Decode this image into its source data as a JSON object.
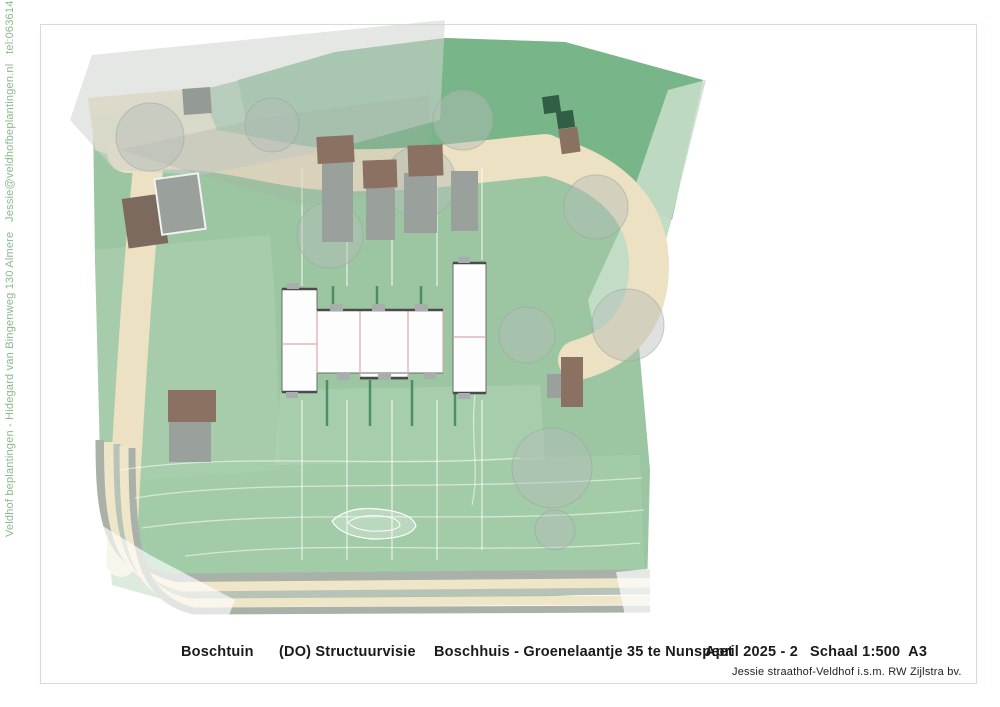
{
  "sidebar": {
    "contact_line": "Veldhof beplantingen - Hidegard van Bingenweg 130 Almere   Jessie@veldhofbeplantingen.nl   tel:0636141206"
  },
  "footer": {
    "project": "Boschtuin",
    "phase": "(DO) Structuurvisie",
    "site": "Boschhuis - Groenelaantje 35 te Nunspeet",
    "date": "April 2025 - 2",
    "scale": "Schaal 1:500  A3",
    "credit": "Jessie straathof-Veldhof i.s.m. RW Zijlstra bv."
  },
  "plan": {
    "north": {
      "label": "N",
      "cx": 785,
      "cy": 634,
      "r": 11.5
    },
    "annotations": {
      "th_label": {
        "text": "TH",
        "x": 123,
        "y": 154,
        "w": 27,
        "h": 15
      },
      "berging_label": {
        "text": "Berging en carport 1000x600cm",
        "x": 152,
        "y": 256
      }
    },
    "colors": {
      "frame_green": "#cfe0cc",
      "plot_green": "#9cc6a2",
      "top_band_green": "#74b386",
      "pale_green": "#c9dfcb",
      "path_beige": "#ece1c2",
      "road_gray": "#a9b1a9",
      "road_cream": "#efe5c9",
      "berging_brown": "#8a7162",
      "carport_gray": "#9aa19d",
      "hedge_green": "#41825c",
      "unit_fill": "#fdfdfd",
      "unit_stroke": "#6b6b6b",
      "pink_line": "#dba8a8",
      "accent_dark": "#4b4b4b",
      "treeTypes": {
        "dark": {
          "f": "#2d6f4c",
          "s": "#1e5236"
        },
        "medium": {
          "f": "#57996f",
          "s": "#3d7a53"
        },
        "sage": {
          "f": "#86b693",
          "s": "#6b9f7b"
        },
        "light": {
          "f": "#a9cbb2",
          "s": "#8fb69b"
        },
        "pale": {
          "f": "#c8ddcc",
          "s": "#aec9b6"
        },
        "bright": {
          "f": "#76c087",
          "s": "#57a96b"
        }
      }
    },
    "polygons": [
      {
        "name": "plot-base",
        "points": "93,118 240,80 335,52 445,38 565,42 703,80 670,225 638,335 650,470 647,592 420,602 180,604 112,585 100,450 95,260",
        "fill": "#9cc6a2",
        "op": 1
      },
      {
        "name": "top-band",
        "points": "238,80 335,52 445,38 565,42 703,80 672,220 610,185 545,152 430,160 330,165 250,140",
        "fill": "#74b386",
        "op": 0.9
      },
      {
        "name": "pale-wedge-right",
        "points": "668,90 706,80 670,225 638,340 600,358 588,300 620,230",
        "fill": "#c9dfcb",
        "op": 0.85
      },
      {
        "name": "overlay-left-strip",
        "points": "95,250 270,235 275,300 280,470 150,480 100,470",
        "fill": "#aed2b2",
        "op": 0.55
      },
      {
        "name": "overlay-bottom",
        "points": "130,465 640,455 645,585 145,590",
        "fill": "#a8cfae",
        "op": 0.5
      },
      {
        "name": "overlay-garden",
        "points": "280,390 540,385 545,460 275,465",
        "fill": "#b4d6b8",
        "op": 0.45
      },
      {
        "name": "path-corner-blob",
        "points": "88,98 200,88 225,150 150,170 95,150",
        "fill": "#ece1c2",
        "op": 0.92
      }
    ],
    "beigePaths": [
      {
        "name": "path-top",
        "d": "M 128,152 C 210,138 265,168 340,170 C 415,172 470,162 545,155",
        "w": 42
      },
      {
        "name": "path-right-descender",
        "d": "M 545,155 C 612,172 650,212 649,268 C 648,318 622,348 578,360",
        "w": 40
      },
      {
        "name": "path-left-band",
        "d": "M 150,150 C 138,260 128,420 121,562",
        "w": 30
      }
    ],
    "roadBands": [
      {
        "d": "M 100,440 C 100,520 106,566 170,578 L 650,574",
        "w": 9,
        "c": "#a9b1a9"
      },
      {
        "d": "M 109,442 C 109,524 114,574 176,587 L 650,583",
        "w": 10,
        "c": "#efe5c9"
      },
      {
        "d": "M 117,444 C 117,530 122,582 182,595 L 650,591",
        "w": 7,
        "c": "#b6c3b6"
      },
      {
        "d": "M 124,446 C 124,536 129,590 188,603 L 650,600",
        "w": 9,
        "c": "#efe5c9"
      },
      {
        "d": "M 132,448 C 132,542 137,598 194,611 L 650,609",
        "w": 7,
        "c": "#a9b1a9"
      }
    ],
    "contours": [
      "M 120,470 C 240,452 380,468 520,458",
      "M 135,498 C 260,478 420,492 642,478",
      "M 142,528 C 300,506 470,526 644,510",
      "M 185,556 C 330,538 480,556 640,543",
      "M 475,395 C 470,440 480,470 472,505"
    ],
    "pond": {
      "outer": "M 332,521 Q 348,506 378,509 Q 412,512 416,526 Q 410,539 372,539 Q 340,536 332,521 Z",
      "inner": "M 348,522 Q 360,514 382,516 Q 400,518 400,526 Q 394,532 370,531 Q 352,529 348,522 Z"
    },
    "divisions": [
      [
        302,
        168,
        302,
        286
      ],
      [
        347,
        168,
        347,
        286
      ],
      [
        392,
        168,
        392,
        286
      ],
      [
        437,
        168,
        437,
        286
      ],
      [
        482,
        168,
        482,
        260
      ],
      [
        302,
        400,
        302,
        560
      ],
      [
        347,
        400,
        347,
        560
      ],
      [
        392,
        400,
        392,
        560
      ],
      [
        437,
        400,
        437,
        560
      ],
      [
        482,
        400,
        482,
        550
      ]
    ],
    "hedges": [
      [
        333,
        286,
        333,
        306
      ],
      [
        377,
        286,
        377,
        306
      ],
      [
        421,
        286,
        421,
        306
      ],
      [
        483,
        265,
        483,
        345
      ],
      [
        327,
        380,
        327,
        426
      ],
      [
        370,
        380,
        370,
        426
      ],
      [
        412,
        380,
        412,
        426
      ],
      [
        455,
        380,
        455,
        426
      ]
    ],
    "overlays": [
      {
        "name": "haze-top-left-outer",
        "points": "70,120 92,55 445,20 440,120 330,150 200,175 115,170",
        "fill": "#cfd4cf",
        "op": 0.55
      },
      {
        "name": "haze-top-left-inner",
        "points": "120,150 260,118 430,95 432,190 300,205 190,172",
        "fill": "#a7aea7",
        "op": 0.3
      },
      {
        "name": "haze-bottom-left",
        "points": "85,515 150,555 235,600 225,625 90,618",
        "fill": "#ffffff",
        "op": 0.65
      },
      {
        "name": "haze-bottom-right",
        "points": "616,572 655,568 685,635 630,640",
        "fill": "#ffffff",
        "op": 0.7
      }
    ],
    "ghostTrees": [
      [
        150,
        137,
        34
      ],
      [
        272,
        125,
        27
      ],
      [
        420,
        182,
        36
      ],
      [
        463,
        120,
        30
      ],
      [
        596,
        207,
        32
      ],
      [
        628,
        325,
        36
      ],
      [
        552,
        468,
        40
      ],
      [
        330,
        235,
        33
      ],
      [
        527,
        335,
        28
      ],
      [
        555,
        530,
        20
      ]
    ],
    "buildings": [
      {
        "name": "house-topleft",
        "x": 183,
        "y": 88,
        "w": 28,
        "h": 26,
        "rot": -4,
        "fill": "#949b94"
      },
      {
        "name": "berging-topleft-brown",
        "x": 125,
        "y": 196,
        "w": 40,
        "h": 50,
        "rot": -8,
        "fill": "#7d6a5e"
      },
      {
        "name": "carport-topleft",
        "x": 158,
        "y": 176,
        "w": 44,
        "h": 56,
        "rot": -8,
        "fill": "#9aa19d",
        "stroke": "#f2f2f2",
        "sw": 2
      },
      {
        "name": "carport-1",
        "x": 322,
        "y": 162,
        "w": 31,
        "h": 80,
        "rot": 0,
        "fill": "#9aa19d"
      },
      {
        "name": "carport-2",
        "x": 366,
        "y": 188,
        "w": 29,
        "h": 52,
        "rot": 0,
        "fill": "#9aa19d"
      },
      {
        "name": "carport-3",
        "x": 404,
        "y": 173,
        "w": 33,
        "h": 60,
        "rot": 0,
        "fill": "#9aa19d"
      },
      {
        "name": "carport-4",
        "x": 451,
        "y": 171,
        "w": 27,
        "h": 60,
        "rot": 0,
        "fill": "#9aa19d"
      },
      {
        "name": "berging-1",
        "x": 317,
        "y": 136,
        "w": 37,
        "h": 27,
        "rot": -3,
        "fill": "#8a7162"
      },
      {
        "name": "berging-2",
        "x": 363,
        "y": 160,
        "w": 34,
        "h": 28,
        "rot": -2,
        "fill": "#8a7162"
      },
      {
        "name": "berging-3",
        "x": 408,
        "y": 145,
        "w": 35,
        "h": 31,
        "rot": -2,
        "fill": "#8a7162"
      },
      {
        "name": "hedge-block-1",
        "x": 543,
        "y": 96,
        "w": 17,
        "h": 17,
        "rot": -8,
        "fill": "#315f45"
      },
      {
        "name": "hedge-block-2",
        "x": 557,
        "y": 111,
        "w": 17,
        "h": 17,
        "rot": -8,
        "fill": "#315f45"
      },
      {
        "name": "berging-topright",
        "x": 560,
        "y": 128,
        "w": 19,
        "h": 25,
        "rot": -8,
        "fill": "#8a7162"
      },
      {
        "name": "berging-left",
        "x": 168,
        "y": 390,
        "w": 48,
        "h": 32,
        "rot": 0,
        "fill": "#8a7162"
      },
      {
        "name": "carport-left",
        "x": 169,
        "y": 422,
        "w": 42,
        "h": 40,
        "rot": 0,
        "fill": "#9aa19d"
      },
      {
        "name": "carport-right",
        "x": 547,
        "y": 374,
        "w": 15,
        "h": 24,
        "rot": 0,
        "fill": "#9aa19d"
      },
      {
        "name": "berging-right",
        "x": 561,
        "y": 357,
        "w": 22,
        "h": 50,
        "rot": 0,
        "fill": "#8a7162"
      }
    ],
    "mainBuilding": {
      "rects": [
        {
          "x": 282,
          "y": 289,
          "w": 35,
          "h": 103
        },
        {
          "x": 317,
          "y": 310,
          "w": 126,
          "h": 63
        },
        {
          "x": 453,
          "y": 263,
          "w": 33,
          "h": 130
        },
        {
          "x": 360,
          "y": 373,
          "w": 48,
          "h": 6
        }
      ],
      "pinkLines": [
        [
          317,
          310,
          317,
          373
        ],
        [
          360,
          310,
          360,
          379
        ],
        [
          408,
          310,
          408,
          379
        ],
        [
          443,
          310,
          443,
          373
        ],
        [
          282,
          344,
          317,
          344
        ],
        [
          453,
          337,
          486,
          337
        ]
      ],
      "accents": [
        [
          282,
          289,
          317,
          289
        ],
        [
          317,
          310,
          443,
          310
        ],
        [
          453,
          263,
          486,
          263
        ],
        [
          282,
          392,
          317,
          392
        ],
        [
          360,
          378,
          408,
          378
        ],
        [
          453,
          393,
          486,
          393
        ]
      ],
      "stoops": [
        [
          330,
          304,
          13,
          7
        ],
        [
          372,
          304,
          13,
          7
        ],
        [
          415,
          304,
          13,
          7
        ],
        [
          337,
          373,
          13,
          7
        ],
        [
          378,
          373,
          13,
          7
        ],
        [
          424,
          373,
          12,
          6
        ],
        [
          286,
          392,
          12,
          6
        ],
        [
          458,
          393,
          12,
          6
        ],
        [
          287,
          283,
          12,
          6
        ],
        [
          458,
          257,
          12,
          6
        ]
      ],
      "units": [
        {
          "id": "35a",
          "label": "35a",
          "lx": 305,
          "ly": 330
        },
        {
          "id": "35b",
          "label": "35b",
          "lx": 306,
          "ly": 364
        },
        {
          "id": "35c",
          "label": "35c",
          "lx": 343,
          "ly": 343
        },
        {
          "id": "35d",
          "label": "35d",
          "lx": 382,
          "ly": 350
        },
        {
          "id": "35e",
          "label": "35e",
          "lx": 424,
          "ly": 344
        },
        {
          "id": "35g",
          "label": "35g",
          "lx": 467,
          "ly": 324
        },
        {
          "id": "35f",
          "label": "35f",
          "lx": 468,
          "ly": 359
        }
      ]
    },
    "trees": [
      [
        237,
        101,
        34,
        "dark"
      ],
      [
        306,
        66,
        26,
        "medium"
      ],
      [
        352,
        96,
        29,
        "dark"
      ],
      [
        384,
        64,
        28,
        "dark"
      ],
      [
        313,
        128,
        18,
        "sage"
      ],
      [
        262,
        158,
        26,
        "sage"
      ],
      [
        250,
        183,
        26,
        "sage"
      ],
      [
        309,
        182,
        26,
        "sage"
      ],
      [
        356,
        186,
        27,
        "medium"
      ],
      [
        463,
        64,
        27,
        "medium"
      ],
      [
        506,
        100,
        31,
        "medium"
      ],
      [
        534,
        141,
        26,
        "light"
      ],
      [
        576,
        68,
        29,
        "light"
      ],
      [
        611,
        120,
        28,
        "sage"
      ],
      [
        612,
        54,
        21,
        "light"
      ],
      [
        656,
        76,
        29,
        "light"
      ],
      [
        689,
        141,
        29,
        "pale"
      ],
      [
        649,
        171,
        24,
        "pale"
      ],
      [
        471,
        190,
        28,
        "dark"
      ],
      [
        575,
        237,
        31,
        "dark"
      ],
      [
        544,
        222,
        24,
        "light"
      ],
      [
        527,
        257,
        26,
        "sage"
      ],
      [
        578,
        285,
        32,
        "dark"
      ],
      [
        617,
        235,
        28,
        "sage"
      ],
      [
        621,
        270,
        24,
        "medium"
      ],
      [
        161,
        216,
        28,
        "medium"
      ],
      [
        130,
        228,
        21,
        "sage"
      ],
      [
        213,
        172,
        23,
        "light"
      ],
      [
        236,
        296,
        35,
        "dark"
      ],
      [
        200,
        331,
        25,
        "medium"
      ],
      [
        153,
        297,
        22,
        "light"
      ],
      [
        133,
        321,
        17,
        "sage"
      ],
      [
        251,
        432,
        43,
        "medium"
      ],
      [
        186,
        470,
        24,
        "medium"
      ],
      [
        149,
        508,
        21,
        "sage"
      ],
      [
        257,
        549,
        31,
        "medium"
      ],
      [
        470,
        510,
        40,
        "medium"
      ],
      [
        491,
        556,
        29,
        "dark"
      ],
      [
        545,
        545,
        27,
        "medium"
      ],
      [
        420,
        552,
        24,
        "sage"
      ],
      [
        562,
        487,
        23,
        "sage"
      ],
      [
        617,
        495,
        26,
        "dark"
      ],
      [
        614,
        553,
        26,
        "medium"
      ],
      [
        608,
        430,
        32,
        "sage"
      ],
      [
        570,
        330,
        27,
        "medium"
      ],
      [
        330,
        430,
        16,
        "light"
      ],
      [
        300,
        420,
        13,
        "sage"
      ],
      [
        408,
        437,
        18,
        "medium"
      ],
      [
        346,
        300,
        8,
        "medium"
      ],
      [
        389,
        299,
        8,
        "medium"
      ],
      [
        432,
        300,
        8,
        "light"
      ],
      [
        333,
        391,
        7,
        "light"
      ],
      [
        395,
        392,
        8,
        "medium"
      ],
      [
        452,
        391,
        7,
        "light"
      ],
      [
        597,
        525,
        6,
        "bright"
      ]
    ],
    "shrubs": [
      [
        298,
        570,
        7,
        "medium"
      ],
      [
        312,
        566,
        6,
        "light"
      ],
      [
        326,
        571,
        7,
        "bright"
      ],
      [
        341,
        566,
        6,
        "medium"
      ],
      [
        355,
        572,
        8,
        "light"
      ],
      [
        371,
        567,
        6,
        "bright"
      ],
      [
        385,
        571,
        7,
        "medium"
      ],
      [
        400,
        566,
        6,
        "light"
      ],
      [
        414,
        570,
        7,
        "bright"
      ],
      [
        428,
        565,
        6,
        "medium"
      ],
      [
        442,
        569,
        7,
        "light"
      ],
      [
        455,
        572,
        5,
        "medium"
      ]
    ],
    "leaders": {
      "l1": "189,247 185,218",
      "arrow1": "185,212 181,221 189,220",
      "l2": "293,251 308,244 330,204",
      "arrow2": "331,199 325,208 335,206"
    }
  }
}
